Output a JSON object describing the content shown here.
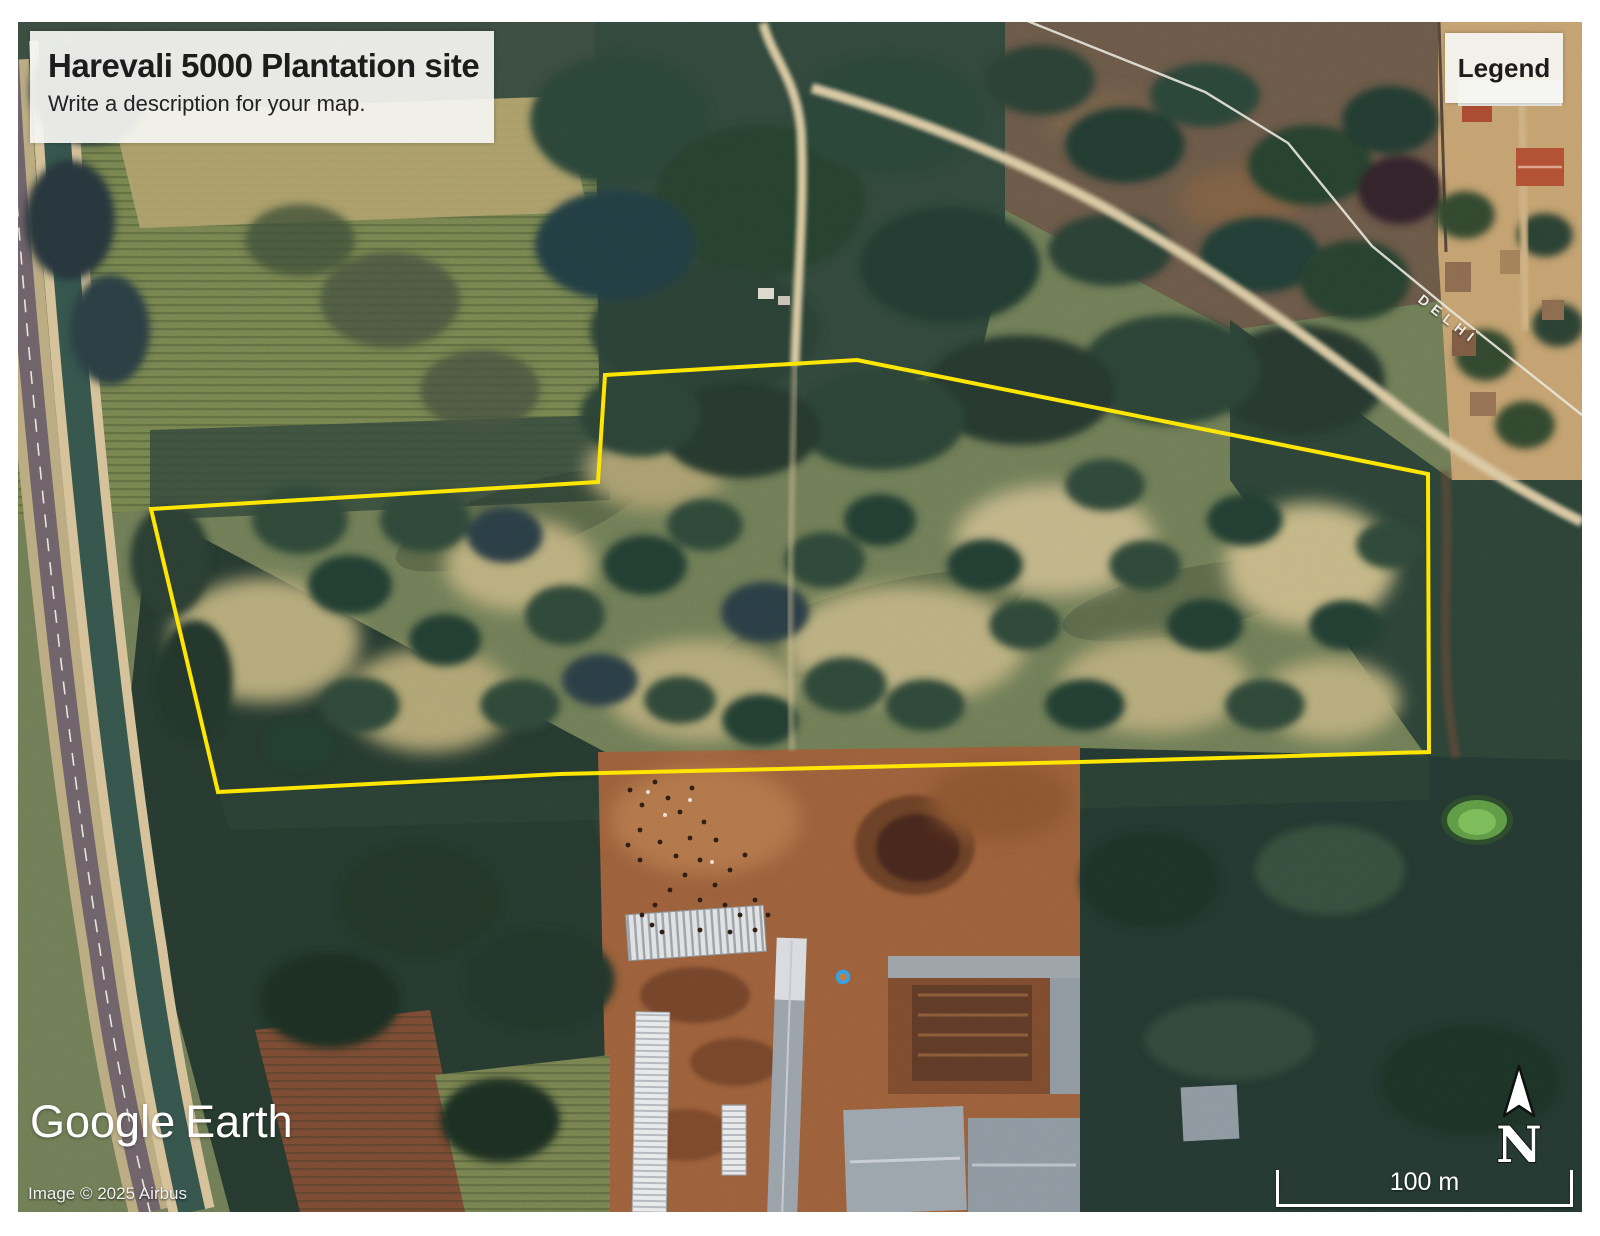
{
  "map": {
    "title_card": {
      "title": "Harevali 5000 Plantation site",
      "description": "Write a description for your map."
    },
    "legend_card": {
      "label": "Legend"
    },
    "road_label": "DELHI",
    "watermark": {
      "brand": "Google",
      "product": "Earth"
    },
    "attribution": "Image © 2025 Airbus",
    "scale_bar": {
      "label": "100 m"
    },
    "compass": {
      "label": "N"
    },
    "colors": {
      "site_boundary": "#ffe600",
      "canal_water": "#35544b",
      "farm_dirt": "#9a5f3a",
      "forest_dark": "#26392f"
    }
  }
}
